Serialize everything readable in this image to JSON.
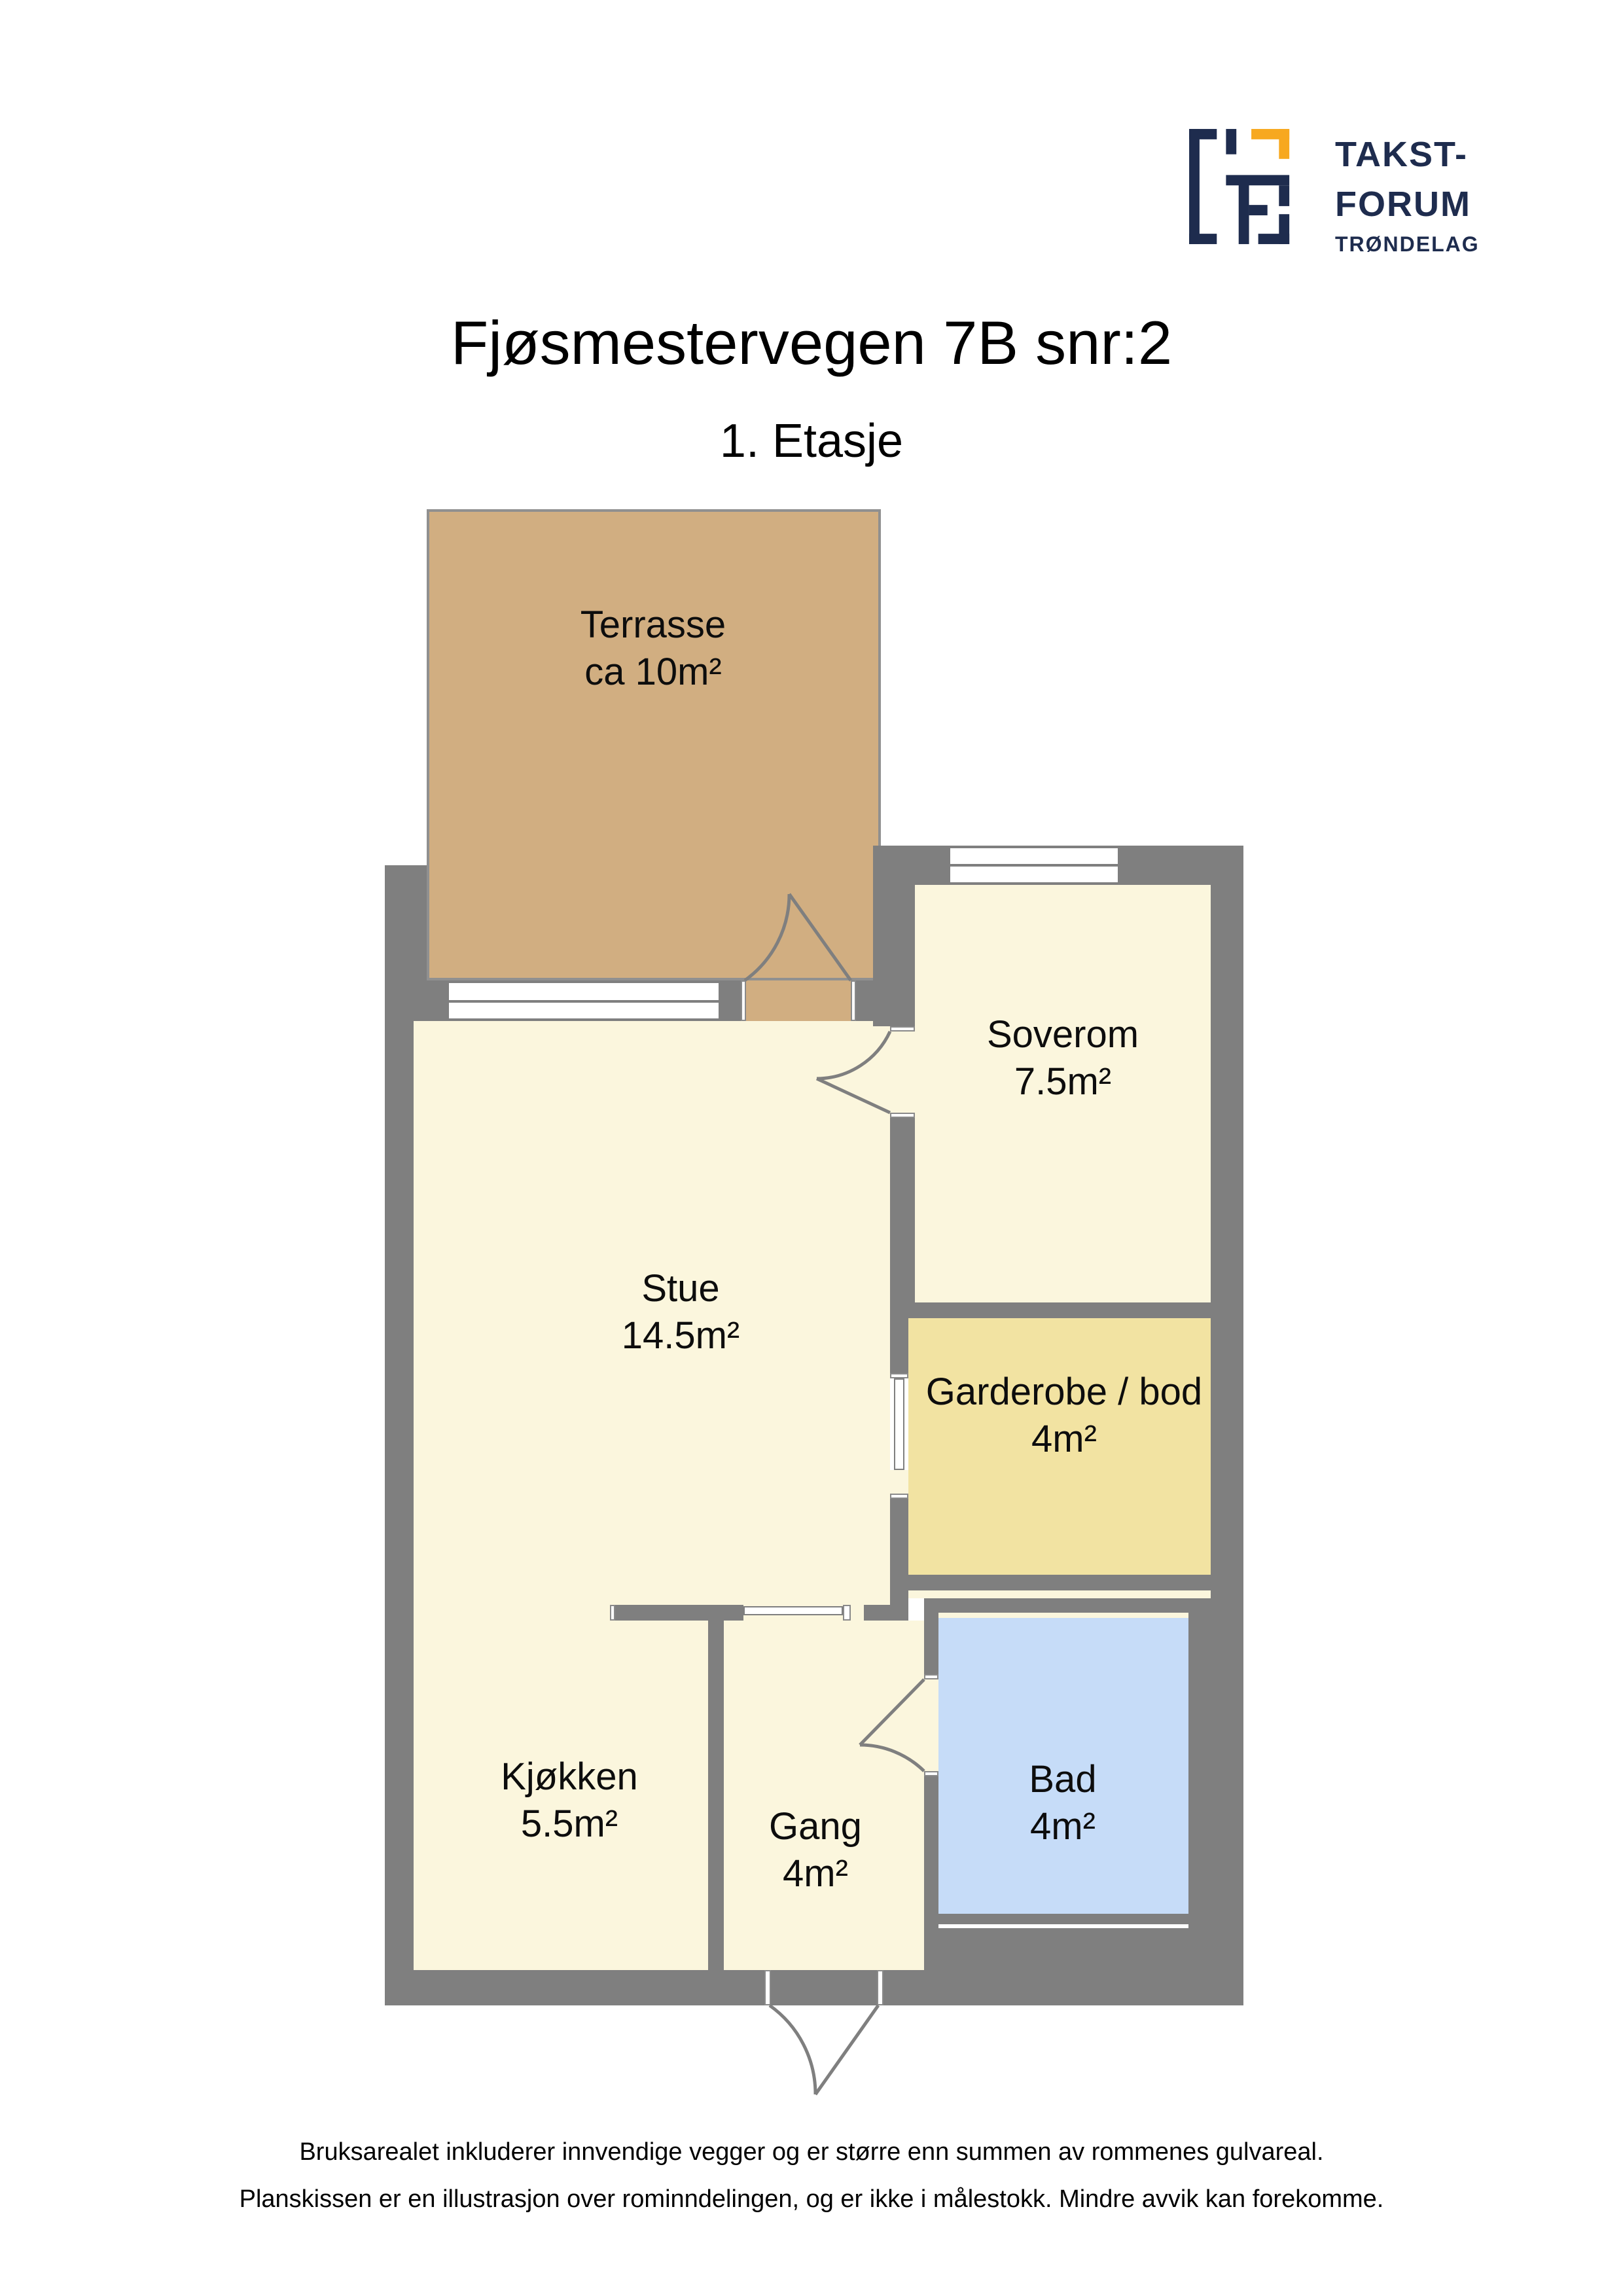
{
  "header": {
    "title": "Fjøsmestervegen 7B snr:2",
    "subtitle": "1. Etasje"
  },
  "logo": {
    "word1": "TAKST-",
    "word2": "FORUM",
    "word3": "TRØNDELAG",
    "navy": "#1e2c4e",
    "orange": "#f7a81f"
  },
  "plan": {
    "wall_color": "#7f7f7f",
    "floor_color": "#fbf6dd",
    "window_color": "#ffffff",
    "rooms": [
      {
        "id": "terrasse",
        "name": "Terrasse",
        "area": "ca 10m²",
        "color": "#d1ae81"
      },
      {
        "id": "stue",
        "name": "Stue",
        "area": "14.5m²",
        "color": "#fbf6dd"
      },
      {
        "id": "soverom",
        "name": "Soverom",
        "area": "7.5m²",
        "color": "#fbf6dd"
      },
      {
        "id": "garderobe",
        "name": "Garderobe / bod",
        "area": "4m²",
        "color": "#f2e3a2"
      },
      {
        "id": "kjokken",
        "name": "Kjøkken",
        "area": "5.5m²",
        "color": "#fbf6dd"
      },
      {
        "id": "gang",
        "name": "Gang",
        "area": "4m²",
        "color": "#fbf6dd"
      },
      {
        "id": "bad",
        "name": "Bad",
        "area": "4m²",
        "color": "#c6dcf8"
      }
    ]
  },
  "footer": {
    "line1": "Bruksarealet inkluderer innvendige vegger og er større enn summen av rommenes gulvareal.",
    "line2": "Planskissen er en illustrasjon over rominndelingen, og er ikke i målestokk. Mindre avvik kan forekomme."
  }
}
